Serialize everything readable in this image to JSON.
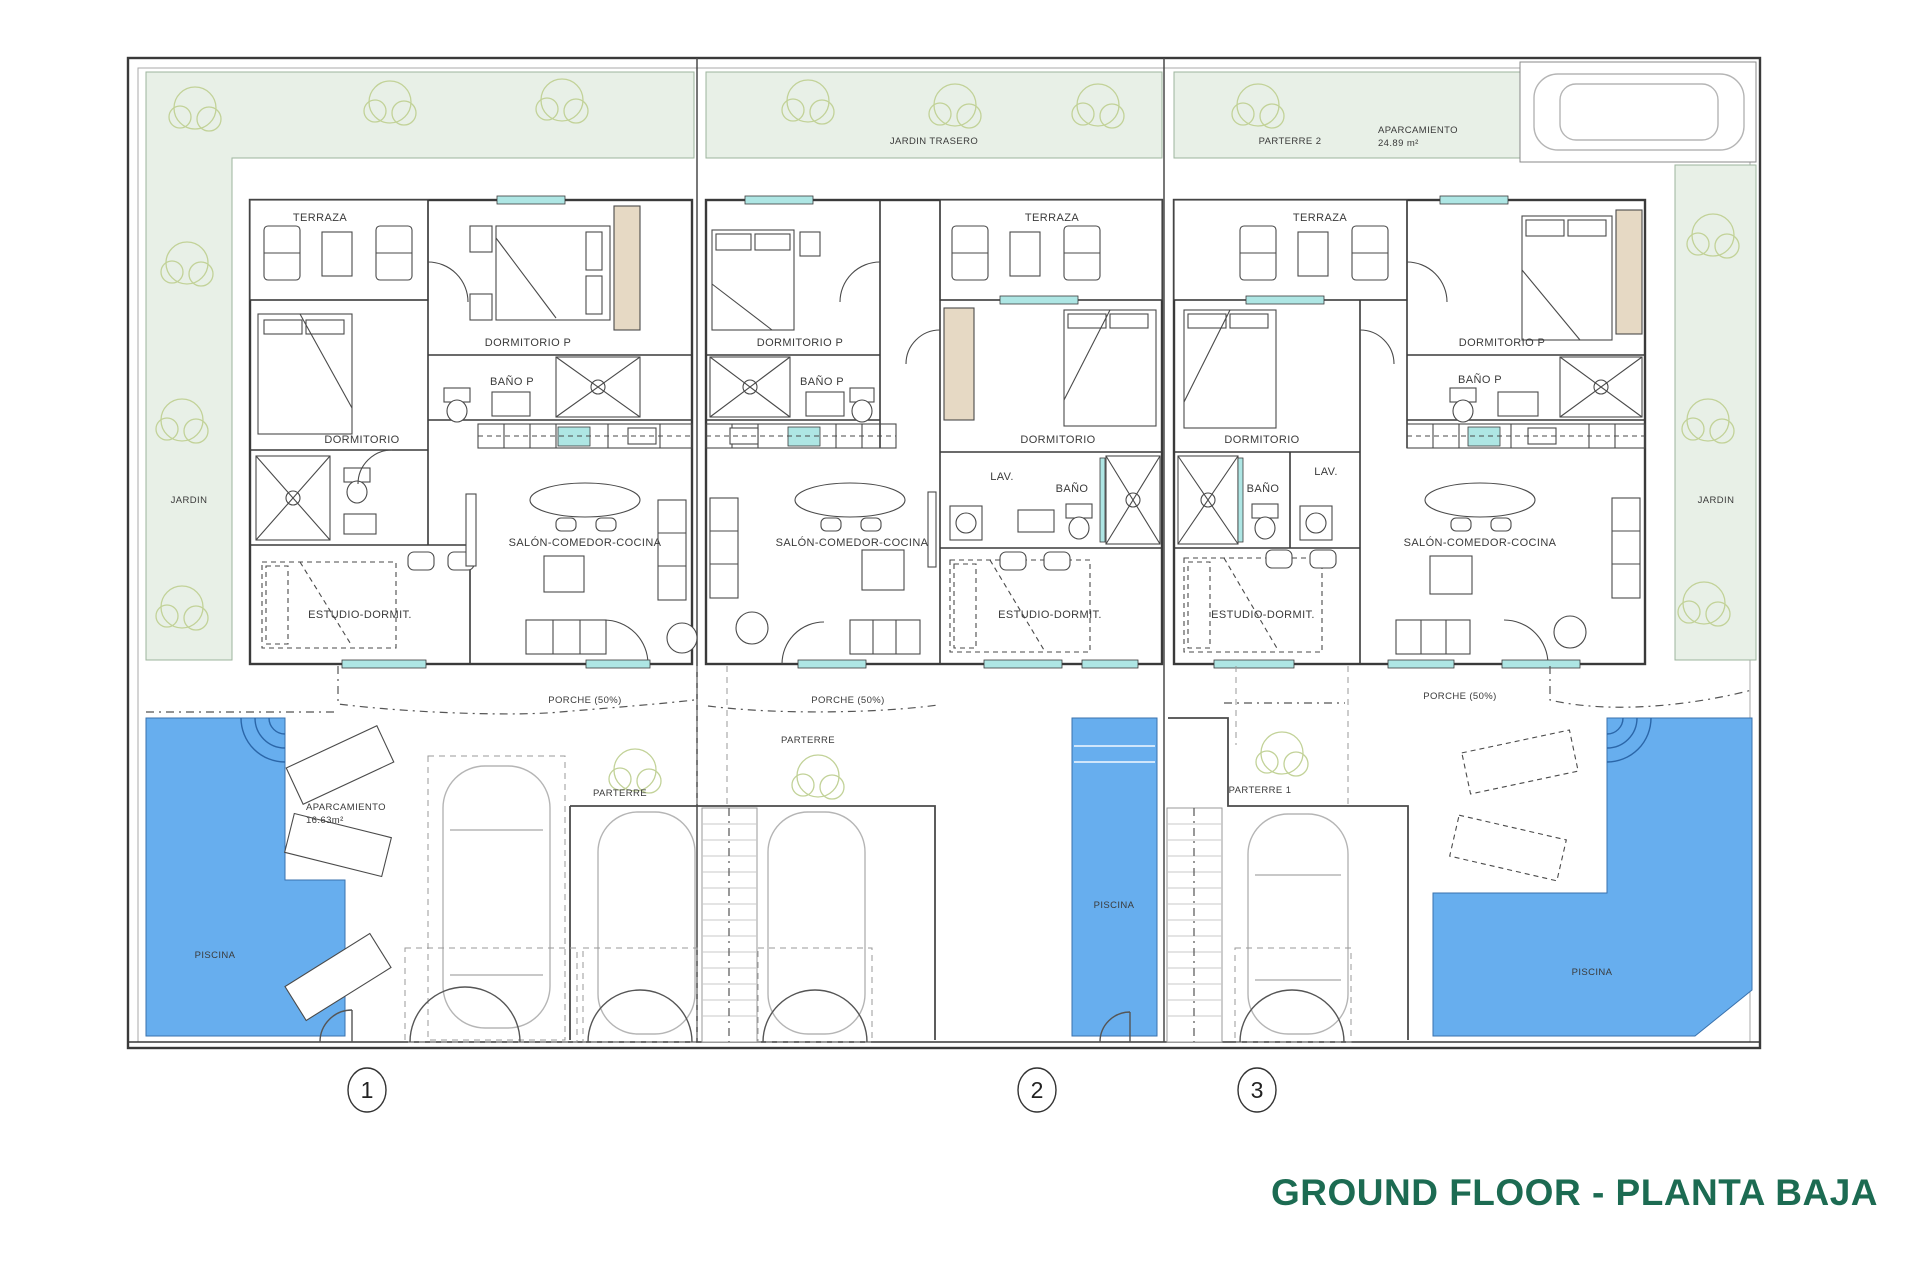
{
  "meta": {
    "title": "GROUND FLOOR - PLANTA BAJA",
    "title_color": "#1C6B52"
  },
  "site": {
    "jardin_left": "JARDIN",
    "jardin_right": "JARDIN",
    "jardin_trasero": "JARDIN TRASERO",
    "parterre_2": "PARTERRE 2",
    "aparcamiento_top": {
      "name": "APARCAMIENTO",
      "area": "24.89 m²"
    }
  },
  "units": [
    {
      "plot_label": "1",
      "fill": "#F6F3D2",
      "rooms": {
        "terraza": "TERRAZA",
        "dormitorio_p": "DORMITORIO P",
        "bano_p": "BAÑO P",
        "dormitorio": "DORMITORIO",
        "salon": "SALÓN-COMEDOR-COCINA",
        "estudio": "ESTUDIO-DORMIT."
      },
      "outdoor": {
        "porche": "PORCHE (50%)",
        "parterre": "PARTERRE",
        "piscina": "PISCINA",
        "aparcamiento": "APARCAMIENTO",
        "aparcamiento_area": "16.63m²"
      }
    },
    {
      "plot_label": "2",
      "fill": "#F8E4D0",
      "rooms": {
        "terraza": "TERRAZA",
        "dormitorio_p": "DORMITORIO P",
        "bano_p": "BAÑO P",
        "dormitorio": "DORMITORIO",
        "lav": "LAV.",
        "bano": "BAÑO",
        "salon": "SALÓN-COMEDOR-COCINA",
        "estudio": "ESTUDIO-DORMIT."
      },
      "outdoor": {
        "porche": "PORCHE (50%)",
        "parterre": "PARTERRE",
        "piscina": "PISCINA"
      }
    },
    {
      "plot_label": "3",
      "fill": "#E9D3D8",
      "rooms": {
        "terraza": "TERRAZA",
        "dormitorio_p": "DORMITORIO P",
        "bano_p": "BAÑO P",
        "dormitorio": "DORMITORIO",
        "lav": "LAV.",
        "bano": "BAÑO",
        "salon": "SALÓN-COMEDOR-COCINA",
        "estudio": "ESTUDIO-DORMIT."
      },
      "outdoor": {
        "porche": "PORCHE (50%)",
        "parterre": "PARTERRE 1",
        "piscina": "PISCINA"
      }
    }
  ],
  "colors": {
    "pool": "#67AEEE",
    "garden": "#E8F0E7",
    "window": "#AEE6E4",
    "wall": "#3A3A3A",
    "tree": "#C2D298"
  }
}
